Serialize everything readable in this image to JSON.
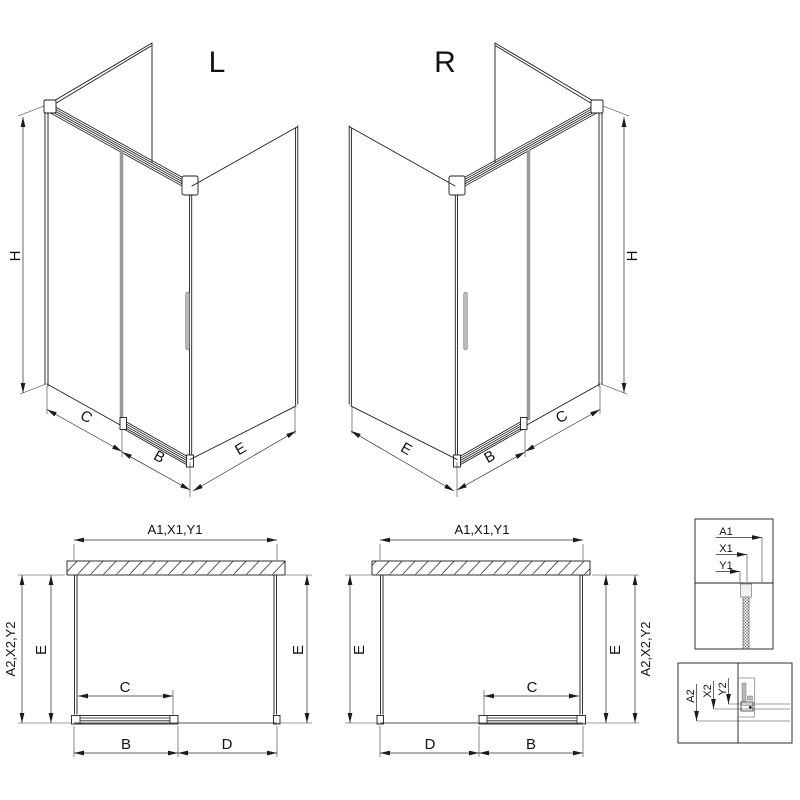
{
  "views": {
    "iso_left": {
      "label": "L",
      "dim_height": "H",
      "dim_c": "C",
      "dim_b": "B",
      "dim_e": "E"
    },
    "iso_right": {
      "label": "R",
      "dim_height": "H",
      "dim_c": "C",
      "dim_b": "B",
      "dim_e": "E"
    },
    "plan_left": {
      "dim_top": "A1,X1,Y1",
      "dim_side": "A2,X2,Y2",
      "dim_e_left": "E",
      "dim_e_right": "E",
      "dim_c": "C",
      "dim_b": "B",
      "dim_d": "D"
    },
    "plan_right": {
      "dim_top": "A1,X1,Y1",
      "dim_side": "A2,X2,Y2",
      "dim_e_left": "E",
      "dim_e_right": "E",
      "dim_c": "C",
      "dim_b": "B",
      "dim_d": "D"
    },
    "detail_top": {
      "labels": [
        "A1",
        "X1",
        "Y1"
      ]
    },
    "detail_bottom": {
      "labels": [
        "A2",
        "X2",
        "Y2"
      ]
    }
  },
  "colors": {
    "line": "#1c1c1c",
    "dim": "#2b2b2b",
    "gray": "#989898",
    "background": "#ffffff"
  }
}
